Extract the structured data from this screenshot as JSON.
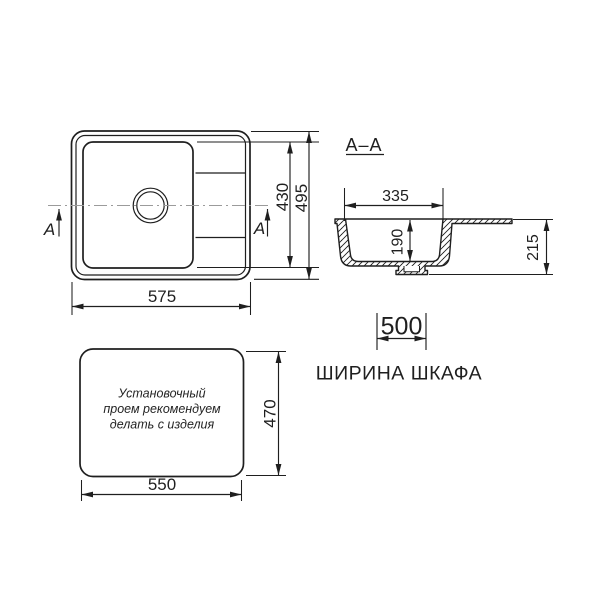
{
  "drawing": {
    "section_title": "A–A",
    "section_marker": "A",
    "cabinet_width_label": "ШИРИНА ШКАФА",
    "dims": {
      "sink_width": "575",
      "bowl_inner_depth": "430",
      "sink_depth": "495",
      "bowl_width": "335",
      "bowl_depth": "190",
      "sink_height": "215",
      "cabinet_width": "500",
      "cutout_width": "550",
      "cutout_depth": "470"
    },
    "install_note": {
      "line1": "Установочный",
      "line2": "проем рекомендуем",
      "line3": "делать с изделия"
    }
  },
  "colors": {
    "line": "#1f1f1f",
    "centerline": "#9b9b9b",
    "background": "#ffffff"
  }
}
